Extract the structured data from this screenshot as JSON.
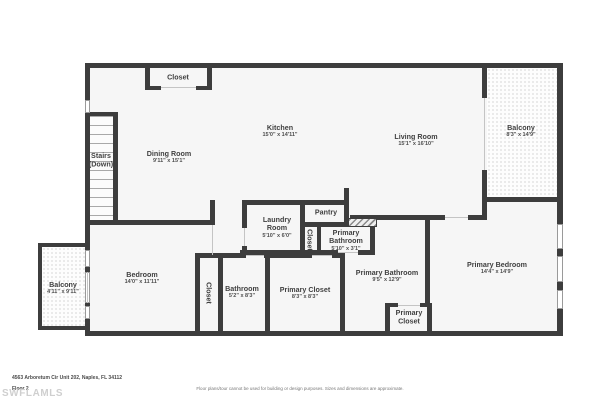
{
  "plan": {
    "rooms": {
      "closet_top": {
        "name": "Closet"
      },
      "dining": {
        "name": "Dining Room",
        "dims": "9'11\" x 15'1\""
      },
      "stairs": {
        "line1": "Stairs",
        "line2": "(Down)"
      },
      "kitchen": {
        "name": "Kitchen",
        "dims": "15'0\" x 14'11\""
      },
      "living": {
        "name": "Living Room",
        "dims": "15'1\" x 16'10\""
      },
      "balcony_right": {
        "name": "Balcony",
        "dims": "8'3\" x 14'9\""
      },
      "laundry": {
        "line1": "Laundry",
        "line2": "Room",
        "dims": "5'10\" x 6'0\""
      },
      "pantry": {
        "name": "Pantry"
      },
      "closet_mid": {
        "name": "Closet"
      },
      "primary_bath_small": {
        "line1": "Primary",
        "line2": "Bathroom",
        "dims": "5'10\" x 3'1\""
      },
      "bedroom": {
        "name": "Bedroom",
        "dims": "14'0\" x 11'11\""
      },
      "balcony_left": {
        "name": "Balcony",
        "dims": "4'11\" x 9'11\""
      },
      "closet_lower": {
        "name": "Closet"
      },
      "bathroom": {
        "name": "Bathroom",
        "dims": "5'2\" x 8'3\""
      },
      "primary_closet": {
        "name": "Primary Closet",
        "dims": "8'3\" x 8'3\""
      },
      "primary_bath": {
        "name": "Primary Bathroom",
        "dims": "9'5\" x 12'9\""
      },
      "primary_bedroom": {
        "name": "Primary Bedroom",
        "dims": "14'4\" x 14'9\""
      },
      "primary_closet_small": {
        "line1": "Primary",
        "line2": "Closet"
      }
    }
  },
  "footer": {
    "address": "4563 Arboretum Cir Unit 202, Naples, FL 34112",
    "floor": "Floor 2",
    "watermark": "SWFLAMLS",
    "disclaimer": "Floor plans/tour cannot be used for building or design purposes. Sizes and dimensions are approximate."
  },
  "colors": {
    "wall": "#3d3d3d",
    "room_fill": "#f6f6f6",
    "label_text": "#3f3f3f"
  }
}
